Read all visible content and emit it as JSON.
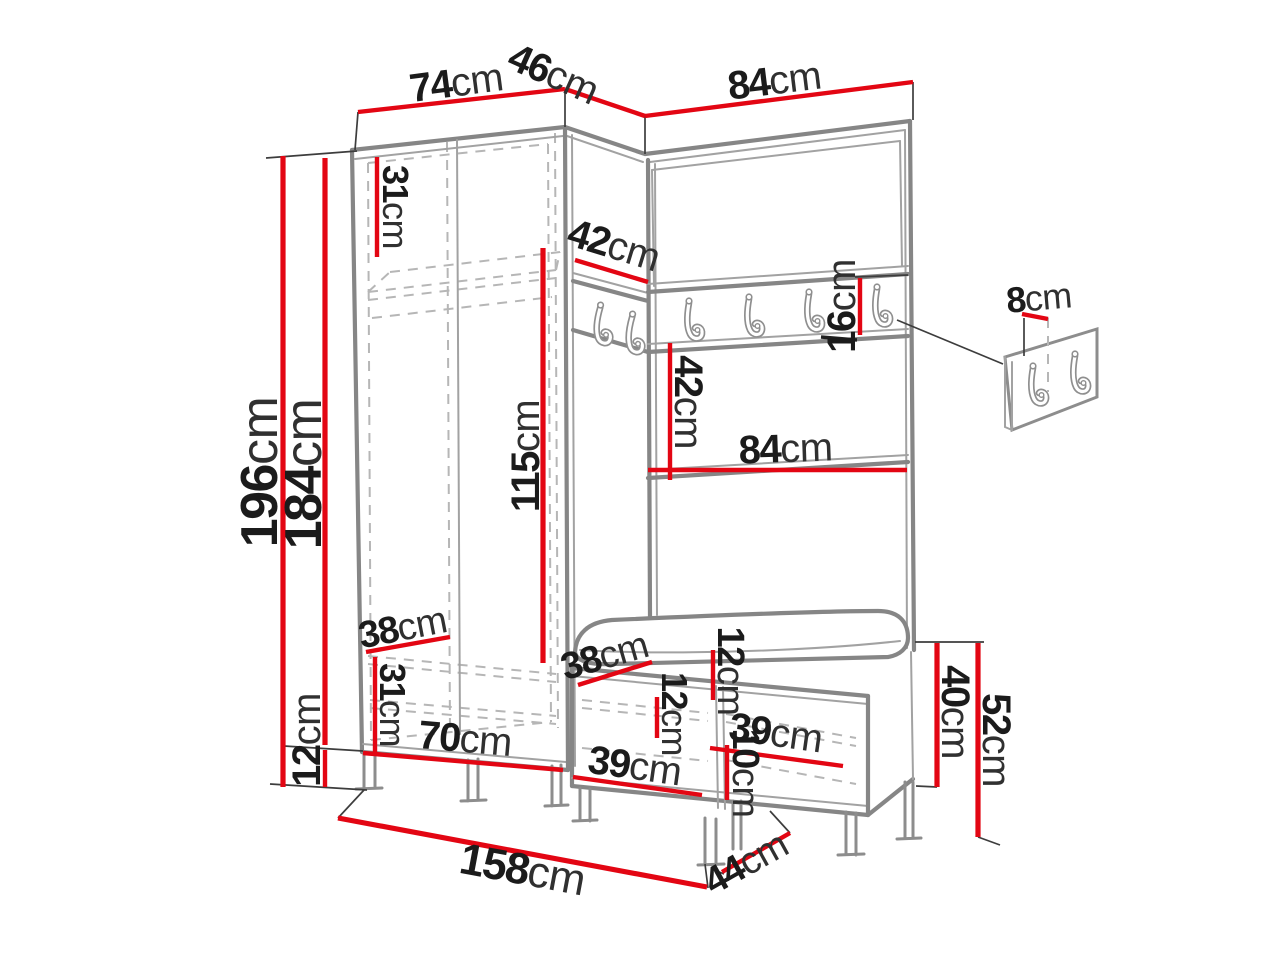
{
  "diagram": {
    "type": "furniture-dimension-diagram",
    "subject": "corner hallway wardrobe set with coat hook rail, bench with cushion and separate wall hook panel",
    "background_color": "#ffffff",
    "dimension_line_color": "#e30613",
    "outline_color": "#868686",
    "label_color": "#1b1b1b",
    "unit": "cm",
    "features": {
      "rail_hook_count": 6,
      "wall_panel_hook_count": 2
    },
    "dims": {
      "top_left_width": {
        "v": "74",
        "u": "cm"
      },
      "corner_depth": {
        "v": "46",
        "u": "cm"
      },
      "top_right_width": {
        "v": "84",
        "u": "cm"
      },
      "total_height": {
        "v": "196",
        "u": "cm"
      },
      "cabinet_height": {
        "v": "184",
        "u": "cm"
      },
      "leg_height": {
        "v": "12",
        "u": "cm"
      },
      "top_shelf_height": {
        "v": "31",
        "u": "cm"
      },
      "corner_shelf_depth": {
        "v": "42",
        "u": "cm"
      },
      "hanging_space_height": {
        "v": "115",
        "u": "cm"
      },
      "hook_rail_height": {
        "v": "16",
        "u": "cm"
      },
      "shelf_gap_height": {
        "v": "42",
        "u": "cm"
      },
      "shelf_width": {
        "v": "84",
        "u": "cm"
      },
      "bottom_compartment_depth": {
        "v": "38",
        "u": "cm"
      },
      "bottom_shelf_height": {
        "v": "31",
        "u": "cm"
      },
      "cabinet_inner_width": {
        "v": "70",
        "u": "cm"
      },
      "bench_inner_depth": {
        "v": "38",
        "u": "cm"
      },
      "cushion_thickness": {
        "v": "12",
        "u": "cm"
      },
      "bench_inner_height": {
        "v": "12",
        "u": "cm"
      },
      "bench_right_compartment": {
        "v": "39",
        "u": "cm"
      },
      "bench_plinth_height": {
        "v": "10",
        "u": "cm"
      },
      "bench_left_compartment": {
        "v": "39",
        "u": "cm"
      },
      "bench_body_height": {
        "v": "40",
        "u": "cm"
      },
      "bench_total_height": {
        "v": "52",
        "u": "cm"
      },
      "bench_depth": {
        "v": "44",
        "u": "cm"
      },
      "total_width": {
        "v": "158",
        "u": "cm"
      },
      "wall_hook_offset": {
        "v": "8",
        "u": "cm"
      }
    }
  }
}
